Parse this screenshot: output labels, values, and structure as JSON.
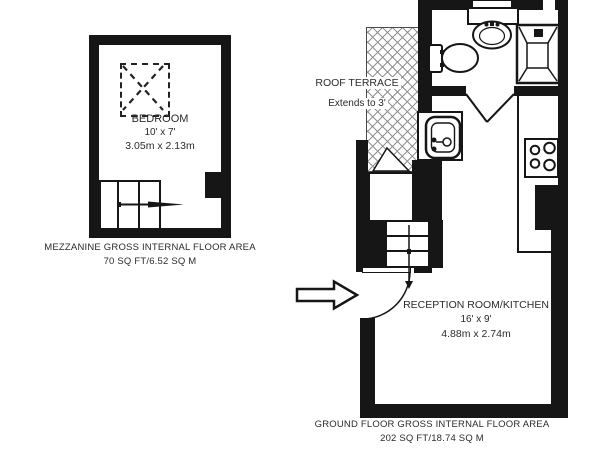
{
  "colors": {
    "wall": "#161616",
    "hatch_line": "#8c8c8c",
    "text": "#2b2b2b"
  },
  "mezzanine": {
    "room": {
      "name": "BEDROOM",
      "size_imperial": "10' x 7'",
      "size_metric": "3.05m x 2.13m"
    },
    "caption": {
      "line1": "MEZZANINE GROSS INTERNAL FLOOR AREA",
      "line2": "70 SQ FT/6.52 SQ M"
    }
  },
  "ground_floor": {
    "terrace": {
      "name": "ROOF TERRACE",
      "note": "Extends to 3'"
    },
    "room": {
      "name": "RECEPTION ROOM/KITCHEN",
      "size_imperial": "16' x 9'",
      "size_metric": "4.88m x 2.74m"
    },
    "caption": {
      "line1": "GROUND FLOOR GROSS INTERNAL FLOOR AREA",
      "line2": "202 SQ FT/18.74 SQ M"
    }
  },
  "icons": {
    "skylight": "dashed-square-with-x",
    "mezzanine_stairs": "stair-treads-with-right-arrow",
    "ground_stairs": "stair-treads-with-down-arrow",
    "entrance_arrow": "large-outline-right-arrow",
    "entrance_door": "quarter-swing-door",
    "terrace_door": "door-wedge",
    "bathroom_door": "double-leaf-door",
    "toilet": "toilet-top-view",
    "basin": "wash-basin-top-view",
    "shower": "shower-tray-top-view",
    "kitchen_sink": "sink-top-view",
    "hob": "four-ring-hob"
  }
}
